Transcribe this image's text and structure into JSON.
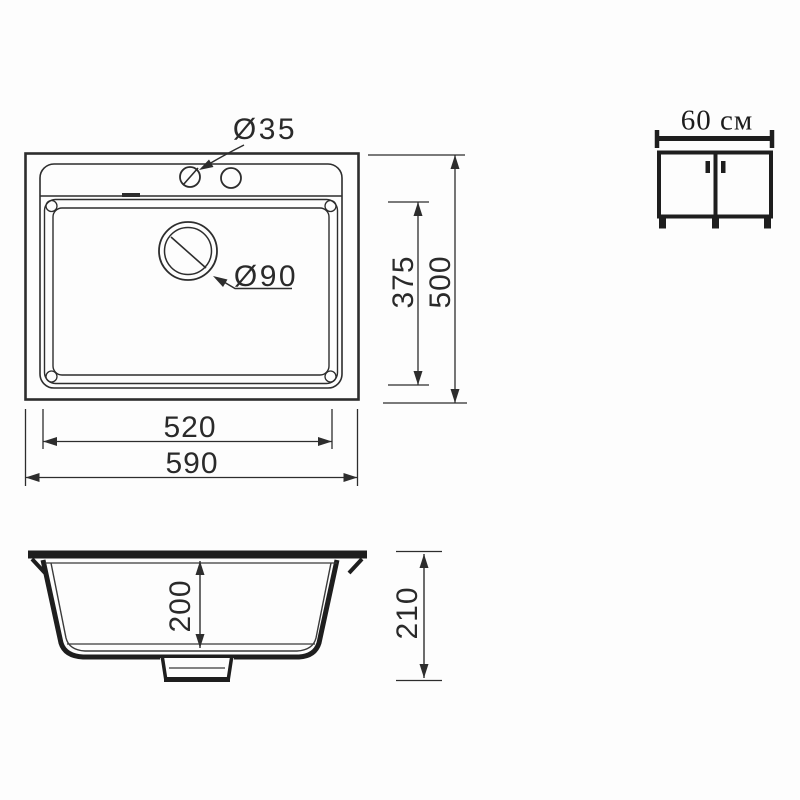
{
  "drawing": {
    "background_color": "#fdfdfd",
    "thin_line_color": "#2d2d2d",
    "thick_line_color": "#1e1e1e"
  },
  "top_view": {
    "faucet_hole_diameter": "Ø35",
    "drain_diameter": "Ø90",
    "bowl_width": "520",
    "overall_width": "590",
    "bowl_depth": "375",
    "overall_depth": "500"
  },
  "section_view": {
    "bowl_height": "200",
    "overall_height": "210"
  },
  "cabinet": {
    "min_width": "60 см"
  }
}
